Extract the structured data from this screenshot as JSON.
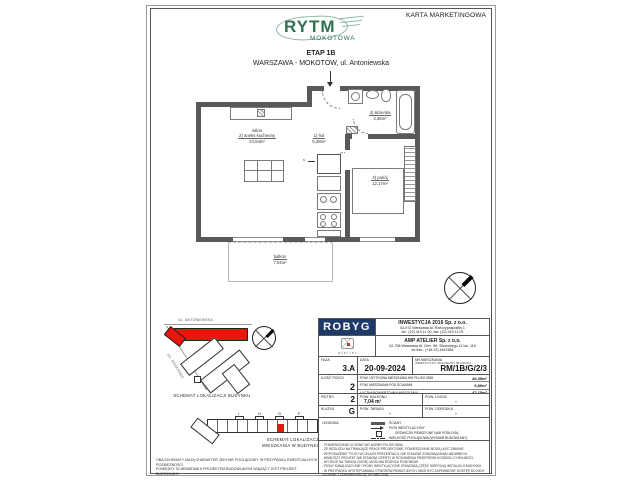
{
  "header": {
    "card_type": "KARTA MARKETINGOWA",
    "logo_line1": "RYTM",
    "logo_line2": "MOKOTOWA",
    "etap": "ETAP 1B",
    "location": "WARSZAWA - MOKOTÓW, ul. Antoniewska"
  },
  "colors": {
    "logo_green": "#2f6f52",
    "robyg_navy": "#1c3968",
    "highlight_red": "#e8170d",
    "wall_gray": "#595959"
  },
  "floor_plan": {
    "salon_line1": "salon",
    "salon_line2": "2) aneks kuchenny",
    "salon_area": "24,54m²",
    "hol_name": "1) hol",
    "hol_area": "5,28m²",
    "lazienka_name": "4) łazienka",
    "lazienka_area": "4,36m²",
    "pokoj_name": "3) pokój",
    "pokoj_area": "12,17m²",
    "balkon_name": "balkon",
    "balkon_area": "7,04m²",
    "wardrobe_mark": "s"
  },
  "site_plan": {
    "street_top": "UL. ANTONIEWSKA",
    "street_left": "UL. GOŚCINIEC",
    "caption": "SCHEMAT LOKALIZACJI BUDYNKU"
  },
  "unit_plan": {
    "stair_letters": [
      "I",
      "H",
      "G",
      "F"
    ],
    "caption_line1": "SCHEMAT LOKALIZACJI",
    "caption_line2": "MIESZKANIA W BUDYNKU"
  },
  "schemes_note": {
    "line1": "OBA SCHEMATY MAJĄ CHARAKTER JEDYNIE POGLĄDOWY. W PRZYPADKU EWENTUALNYCH ROZBIEŻNOŚCI",
    "line2": "POMIĘDZY SCHEMATAMI A PROJEKTEM BUDOWLANYM WIĄŻĄCY JEST PROJEKT BUDOWLANY."
  },
  "companies": {
    "developer_name": "ROBYG",
    "investor_name": "INWESTYCJA 2016 Sp. z o.o.",
    "investor_address": "02-972 Warszawa Al. Rzeczypospolitej 1",
    "investor_phone": "tel.: (22) 419 11 00, fax: (22) 419 11 03",
    "atelier_logo_text": "atelier",
    "architect_name": "AMP ATELIER Sp. z o.o.",
    "architect_address": "02-758 Warszawa  Al. Gen. Wł. Sikorskiego 11 lok. 116",
    "architect_phone": "tel./fax.: (+48 22) 4467864"
  },
  "table": {
    "faza_label": "FAZA",
    "faza": "3.A",
    "data_label": "DATA",
    "data": "20-09-2024",
    "nr_label": "NR MIESZKANIA",
    "nr_sublabel": "(INWESTYCYJNY / BUDOWLANY NR LOKALU)",
    "nr": "RM/1B/G/2/3",
    "pokoi_label": "ILOŚĆ POKOI",
    "pokoi": "2",
    "area_rows": [
      {
        "label": "POW. UŻYTKOWA MIESZKANIA WG PN-ISO 9836",
        "value": "46,35m²"
      },
      {
        "label": "POW. MIESZKANIA POD ŚCIANAMI",
        "value": "0,80m²"
      },
      {
        "label": "ŁĄCZNA POWIERZCHNIA MIESZKANIA",
        "value": "47,15m²"
      }
    ],
    "pietro_label": "PIĘTRO",
    "pietro": "2",
    "balkon_label": "POW. BALKONU",
    "balkon": "7,04 m²",
    "loggia_label": "POW. LOGGII",
    "loggia": "-",
    "klatka_label": "KLATKA",
    "klatka": "G",
    "taras_label": "POW. TARASU",
    "taras": "-",
    "ogrodek_label": "POW. OGRÓDKA",
    "ogrodek": "-"
  },
  "legend": {
    "label": "LEGENDA",
    "items": [
      {
        "symbol": "wall-swatch",
        "text": "ŚCIANY"
      },
      {
        "symbol": "vent-arrow",
        "text": "PION WENTYLACYJNY"
      },
      {
        "symbol": "revision-door",
        "text": "DRZWICZKI REWIZYJNE NAD PODŁOGĄ"
      },
      {
        "symbol": "dimension-mark",
        "text": "WIELKOŚĆ POGLĄDOWA (WYMIAR BUDOWLANY)"
      }
    ]
  },
  "disclaimers": [
    "POWIERZCHNIE LICZONE WG NORMY PN-ISO 9836.",
    "ZE WZGLĘDU NA TRWAJĄCE PRACE PROJEKTOWE, POWIERZCHNIE MOGĄ ULEC ZMIANIE.",
    "WYPOSAŻENIE TYLKO W CELACH PREZENTACJI, NIE STANOWI ZOBOWIĄZANIA UMOWNEGO.",
    "NINIEJSZY PROJEKT NIE STANOWI OFERTY W ROZUMIENIU PRZEPISÓW KODEKSU CYWILNEGO.",
    "WYJŚCIE NA TARAS/LOGGIĘ: MOŻLIWA RÓŻNICA POZIOMÓW.",
    "PIONY KANALIZACYJNE I PIONY WENTYLACYJNE STANOWIĄ CZĘŚĆ WSPÓLNĄ INSTALACJI BUDYNKU.",
    "W PRZYPADKU WYSTĘPOWANIA OTWORÓW REWIZYJNYCH, MUSI BYĆ ZAPEWNIONY DOSTĘP DO NICH ZGODNIE Z DOKUMENTACJĄ TECHNICZNĄ."
  ]
}
